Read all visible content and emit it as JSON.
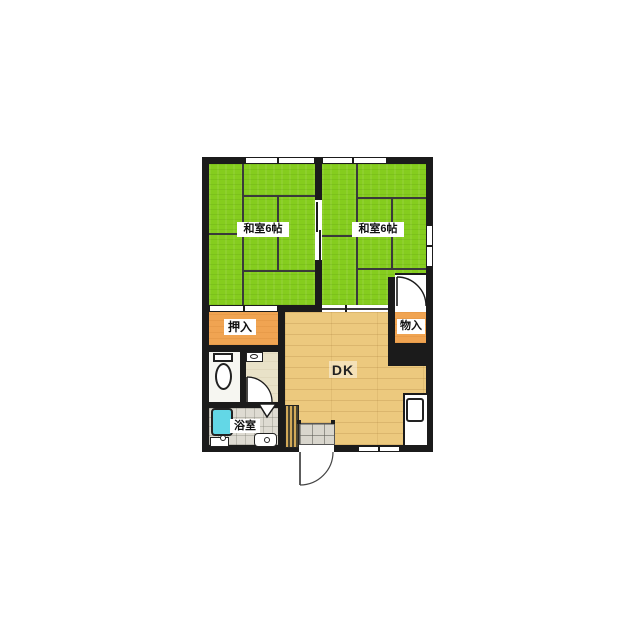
{
  "plan": {
    "room_left_label": "和室6帖",
    "room_right_label": "和室6帖",
    "closet_label": "押入",
    "storage_label": "物入",
    "dining_kitchen_label": "DK",
    "bathroom_label": "浴室"
  },
  "colors": {
    "wall": "#1b1b1b",
    "tatami_green": "#85cd1e",
    "closet_orange": "#f0a452",
    "dk_floor_tan": "#ecc97e",
    "bathtub_cyan": "#63d7e6",
    "bath_tile_gray": "#dedbd2",
    "washroom_beige": "#e9e2c8",
    "background": "#ffffff"
  },
  "legend": {
    "room_left_size_tatami": 6,
    "room_right_size_tatami": 6
  }
}
